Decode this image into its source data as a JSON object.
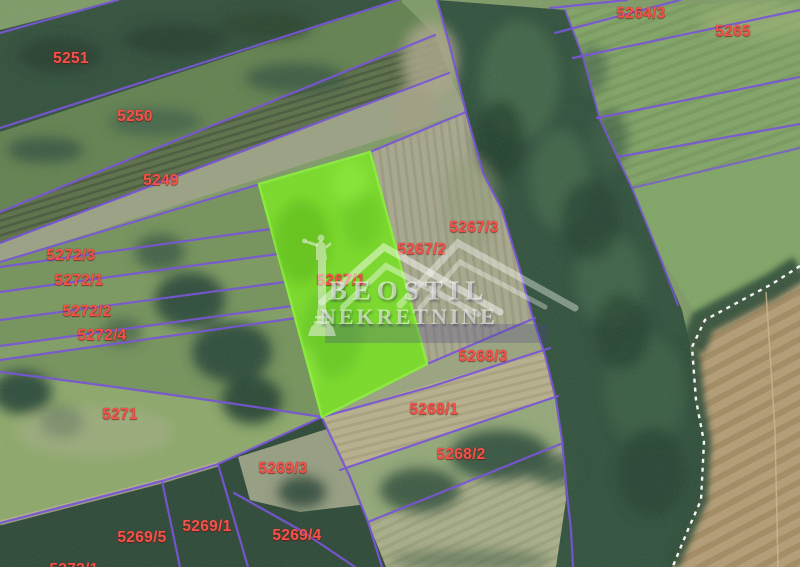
{
  "map": {
    "type": "cadastral-aerial-view",
    "watermark": {
      "line1": "BEOSTIL",
      "line2": "NEKRETNINE"
    },
    "highlight": {
      "parcel": "5267/1",
      "fill": "#7ddd2c"
    },
    "colors": {
      "boundary": "#7956d6",
      "label": "#f4534c",
      "dashed_boundary": "#ffffff",
      "highlight_green": "#7ddd2c"
    },
    "parcel_labels": [
      {
        "text": "5251",
        "x": 71,
        "y": 59
      },
      {
        "text": "5250",
        "x": 135,
        "y": 117
      },
      {
        "text": "5249",
        "x": 161,
        "y": 181
      },
      {
        "text": "5272/3",
        "x": 71,
        "y": 256
      },
      {
        "text": "5272/1",
        "x": 79,
        "y": 281
      },
      {
        "text": "5272/2",
        "x": 87,
        "y": 312
      },
      {
        "text": "5272/4",
        "x": 102,
        "y": 336
      },
      {
        "text": "5271",
        "x": 120,
        "y": 415
      },
      {
        "text": "5264/3",
        "x": 641,
        "y": 14
      },
      {
        "text": "5265",
        "x": 733,
        "y": 32
      },
      {
        "text": "5267/3",
        "x": 474,
        "y": 228
      },
      {
        "text": "5267/2",
        "x": 422,
        "y": 250
      },
      {
        "text": "5267/1",
        "x": 341,
        "y": 281
      },
      {
        "text": "5268/3",
        "x": 483,
        "y": 357
      },
      {
        "text": "5268/1",
        "x": 434,
        "y": 410
      },
      {
        "text": "5268/2",
        "x": 461,
        "y": 455
      },
      {
        "text": "5269/3",
        "x": 283,
        "y": 469
      },
      {
        "text": "5269/1",
        "x": 207,
        "y": 527
      },
      {
        "text": "5269/5",
        "x": 142,
        "y": 538
      },
      {
        "text": "5269/4",
        "x": 297,
        "y": 536
      },
      {
        "text": "5273/1",
        "x": 74,
        "y": 570
      }
    ]
  }
}
